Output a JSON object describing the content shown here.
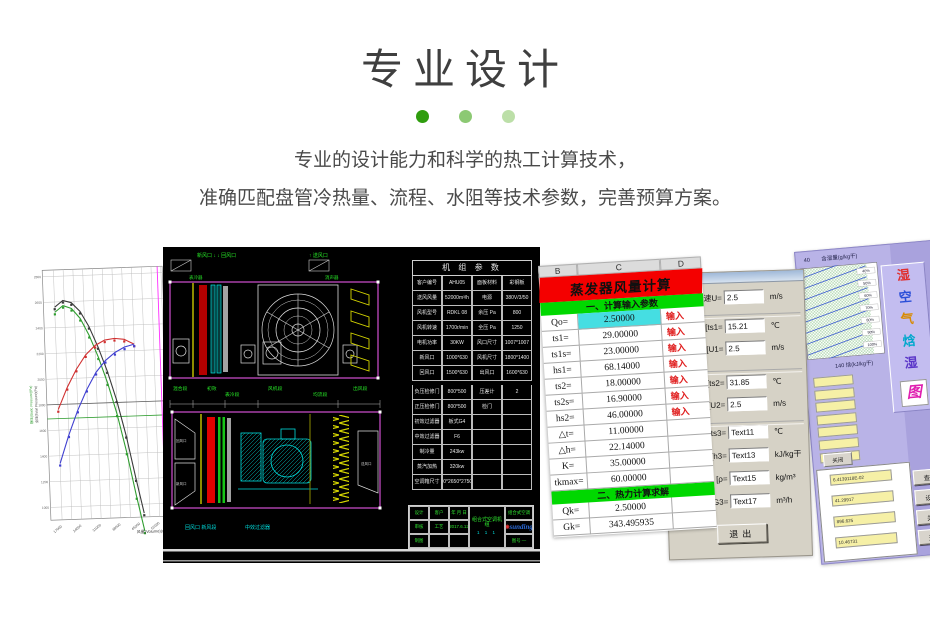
{
  "header": {
    "title": "专业设计",
    "dots": [
      "#2f9d0e",
      "#8cc973",
      "#bcdfa8"
    ],
    "line1": "专业的设计能力和科学的热工计算技术，",
    "line2": "准确匹配盘管冷热量、流程、水阻等技术参数，完善预算方案。"
  },
  "chart_data": {
    "type": "line",
    "title": "风机性能曲线",
    "xlabel": "风量(Volume)(m³/h)",
    "ylabel_left1": "全压(Total Pressure)(Pa)",
    "ylabel_left2": "静压(Static Pressure)(Pa)",
    "xlim": [
      13000,
      56000
    ],
    "ylim": [
      900,
      2850
    ],
    "x_ticks": [
      17000,
      24000,
      31000,
      38000,
      45000,
      52000
    ],
    "y_ticks": [
      1000,
      1200,
      1400,
      1600,
      1800,
      2000,
      2200,
      2400,
      2600,
      2800
    ],
    "ref_lines": [
      {
        "axis": "y",
        "value": 1800,
        "color": "#606060"
      },
      {
        "axis": "y",
        "value": 1690,
        "color": "#2f9d2f"
      },
      {
        "axis": "x",
        "value": 54200,
        "color": "#ff2fff"
      }
    ],
    "series": [
      {
        "name": "curve-black",
        "color": "#3a3a3a",
        "x": [
          17000,
          20000,
          23000,
          26000,
          29000,
          32000,
          35000,
          38000,
          41000,
          44000,
          46500
        ],
        "y": [
          2560,
          2610,
          2590,
          2520,
          2400,
          2240,
          2050,
          1820,
          1540,
          1200,
          930
        ]
      },
      {
        "name": "curve-green",
        "color": "#2f9d2f",
        "x": [
          17000,
          20000,
          23000,
          26000,
          29000,
          32000,
          35000,
          38000,
          41000,
          44000,
          46500
        ],
        "y": [
          2520,
          2570,
          2545,
          2465,
          2330,
          2160,
          1955,
          1710,
          1410,
          1060,
          790
        ]
      },
      {
        "name": "curve-red",
        "color": "#d03030",
        "x": [
          17000,
          20500,
          24000,
          27500,
          31000,
          34500,
          38000,
          41500,
          45000
        ],
        "y": [
          1760,
          1930,
          2070,
          2180,
          2250,
          2290,
          2300,
          2290,
          2250
        ]
      },
      {
        "name": "curve-blue",
        "color": "#4040d0",
        "x": [
          17000,
          20500,
          24000,
          27500,
          31000,
          34500,
          38000,
          41500,
          45000
        ],
        "y": [
          1340,
          1560,
          1750,
          1910,
          2040,
          2130,
          2190,
          2230,
          2250
        ]
      }
    ]
  },
  "cad": {
    "top_symbols": {
      "left": "新风口 ↓ ↓ 回风口",
      "right": "↑ 送风口"
    },
    "above_labels": [
      "表冷器",
      "消声器"
    ],
    "seg_labels": [
      "混合段",
      "初效",
      "表冷段",
      "风机段",
      "均流段",
      "出风段"
    ],
    "bottom_labels": [
      "回风口 新风段",
      "中效过滤器"
    ],
    "side_labels": {
      "left_top": "回风口",
      "left_bottom": "新风口",
      "right": "送风口"
    },
    "table": {
      "title": "机 组 参 数",
      "rows": [
        [
          "客户编号",
          "AHU05",
          "面板材料",
          "彩钢板"
        ],
        [
          "送风风量",
          "52000m³/h",
          "电源",
          "380V/3/50"
        ],
        [
          "风机型号",
          "RDKL 08",
          "余压 Pa",
          "800"
        ],
        [
          "风机转速",
          "1700r/min",
          "全压 Pa",
          "1250"
        ],
        [
          "电机功率",
          "30KW",
          "风口尺寸",
          "1007*1007"
        ],
        [
          "新风口",
          "1000*630",
          "风机尺寸",
          "1800*1400"
        ],
        [
          "回风口",
          "1500*630",
          "出风口",
          "1600*630"
        ],
        [
          "负压检修门",
          "800*500",
          "压差计",
          "2"
        ],
        [
          "正压检修门",
          "800*500",
          "检门",
          ""
        ],
        [
          "初效过滤器",
          "板式G4",
          "",
          ""
        ],
        [
          "中效过滤器",
          "F6",
          "",
          ""
        ],
        [
          "制冷量",
          "243kw",
          "",
          ""
        ],
        [
          "蒸汽加热",
          "320kw",
          "",
          ""
        ],
        [
          "空调箱尺寸",
          "6500*2650*2750(H)",
          "",
          ""
        ]
      ]
    },
    "titleblock": {
      "rows": [
        [
          "设计",
          "客户",
          "年 月 日"
        ],
        [
          "审核",
          "工艺",
          "2017.6.12"
        ],
        [
          "制图",
          "",
          ""
        ]
      ],
      "center": "组合式空调机组",
      "marks": "1 1 1",
      "right_top": "组合式空调",
      "logo": "sunding",
      "right_bottom": "图号 —"
    }
  },
  "sheet": {
    "columns": [
      "B",
      "C",
      "D"
    ],
    "title": "蒸发器风量计算",
    "section1": "一、计算输入参数",
    "rows1": [
      {
        "l": "Qo=",
        "v": "2.50000",
        "n": "输入",
        "vbg": "#45dee2"
      },
      {
        "l": "ts1=",
        "v": "29.00000",
        "n": "输入"
      },
      {
        "l": "ts1s=",
        "v": "23.00000",
        "n": "输入"
      },
      {
        "l": "hs1=",
        "v": "68.14000",
        "n": "输入"
      },
      {
        "l": "ts2=",
        "v": "18.00000",
        "n": "输入"
      },
      {
        "l": "ts2s=",
        "v": "16.90000",
        "n": "输入"
      },
      {
        "l": "hs2=",
        "v": "46.00000",
        "n": "输入"
      },
      {
        "l": "△t=",
        "v": "11.00000",
        "n": ""
      },
      {
        "l": "△h=",
        "v": "22.14000",
        "n": ""
      },
      {
        "l": "K=",
        "v": "35.00000",
        "n": ""
      },
      {
        "l": "tkmax=",
        "v": "60.00000",
        "n": ""
      }
    ],
    "section2": "二、热力计算求解",
    "rows2": [
      {
        "l": "Qk=",
        "v": "2.50000",
        "n": ""
      },
      {
        "l": "Gk=",
        "v": "343.495935",
        "n": ""
      }
    ]
  },
  "dialog": {
    "rows": [
      {
        "label": "速U=",
        "value": "2.5",
        "unit": "m/s"
      },
      {
        "label": "[ts1=",
        "value": "15.21",
        "unit": "℃"
      },
      {
        "label": "[U1=",
        "value": "2.5",
        "unit": "m/s"
      },
      {
        "label": "[ts2=",
        "value": "31.85",
        "unit": "℃"
      },
      {
        "label": "[U2=",
        "value": "2.5",
        "unit": "m/s"
      },
      {
        "label": "[ts3=",
        "value": "Text11",
        "unit": "℃"
      },
      {
        "label": "[h3=",
        "value": "Text13",
        "unit": "kJ/kg干"
      },
      {
        "label": "[ρ=",
        "value": "Text15",
        "unit": "kg/m³"
      },
      {
        "label": "量G3=",
        "value": "Text17",
        "unit": "m³/h"
      }
    ],
    "exit_label": "退出"
  },
  "psy": {
    "top_tick": "40",
    "top_label": "含湿量(g/kg干)",
    "bottom_tick": "140",
    "bottom_label": "焓(kJ/kg干)",
    "humidity_labels": [
      "40%",
      "50%",
      "60%",
      "70%",
      "80%",
      "90%",
      "100%"
    ],
    "title_chars": [
      {
        "t": "湿",
        "c": "#e03030"
      },
      {
        "t": "空",
        "c": "#2b4fd8"
      },
      {
        "t": "气",
        "c": "#d88a00"
      },
      {
        "t": "焓",
        "c": "#00a8cc"
      },
      {
        "t": "湿",
        "c": "#5a35c8"
      }
    ],
    "glyph_char": "图",
    "close_label": "关闭",
    "result_values": [
      "6.4139118E-02",
      "41.29917",
      "896.625",
      "10.46731"
    ],
    "buttons": [
      "查询",
      "设置",
      "关于",
      "退出"
    ]
  }
}
